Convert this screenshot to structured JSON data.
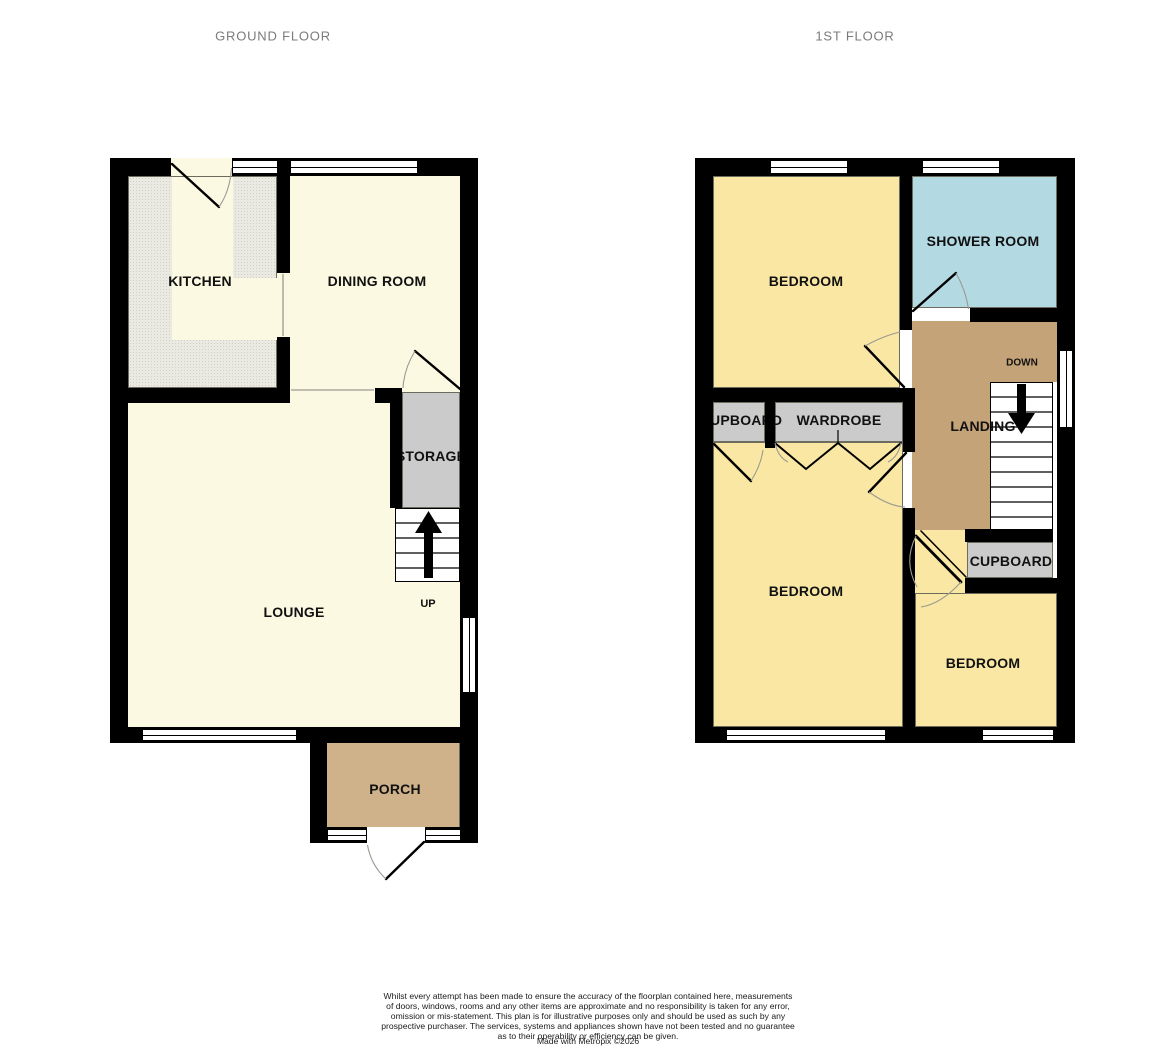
{
  "ground_floor": {
    "title": "GROUND FLOOR",
    "rooms": {
      "kitchen": "KITCHEN",
      "dining_room": "DINING ROOM",
      "storage": "STORAGE",
      "lounge": "LOUNGE",
      "porch": "PORCH"
    },
    "stairs": {
      "direction_label": "UP"
    }
  },
  "first_floor": {
    "title": "1ST FLOOR",
    "rooms": {
      "bedroom_top": "BEDROOM",
      "shower_room": "SHOWER ROOM",
      "cupboard_left": "CUPBOARD",
      "wardrobe": "WARDROBE",
      "landing": "LANDING",
      "bedroom_left": "BEDROOM",
      "bedroom_right": "BEDROOM",
      "cupboard_right": "CUPBOARD"
    },
    "stairs": {
      "direction_label": "DOWN"
    }
  },
  "footer": {
    "disclaimer": "Whilst every attempt has been made to ensure the accuracy of the floorplan contained here, measurements\nof doors, windows, rooms and any other items are approximate and no responsibility is taken for any error,\nomission or mis-statement. This plan is for illustrative purposes only and should be used as such by any\nprospective purchaser. The services, systems and appliances shown have not been tested and no guarantee\nas to their operability or efficiency can be given.",
    "credit": "Made with Metropix ©2026"
  },
  "colors": {
    "wall": "#000000",
    "cream": "#FCF9E3",
    "kitchen_floor": "#EAEAE3",
    "kitchen_dot": "#CFCFC4",
    "yellow": "#F9E7A3",
    "shower_blue": "#B3DAE3",
    "landing_tan": "#C5A378",
    "porch_tan": "#CFB18A",
    "unit_gray": "#CBCBCB",
    "title_gray": "#7B7B7B"
  }
}
